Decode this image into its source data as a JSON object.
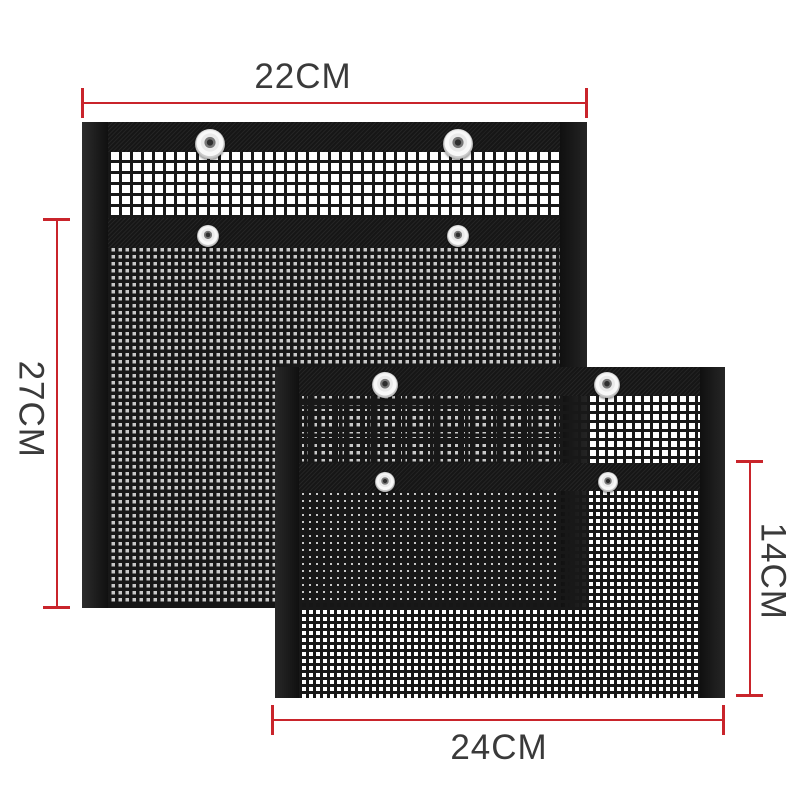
{
  "annotations": {
    "top_width": "22CM",
    "left_height": "27CM",
    "right_height": "14CM",
    "bottom_width": "24CM"
  },
  "bags": {
    "large": {
      "snap_count": 4
    },
    "small": {
      "snap_count": 4
    }
  },
  "colors": {
    "dimension_red": "#c9242b",
    "label_text": "#3a3a3a",
    "fabric_black": "#161616",
    "background": "#ffffff"
  }
}
